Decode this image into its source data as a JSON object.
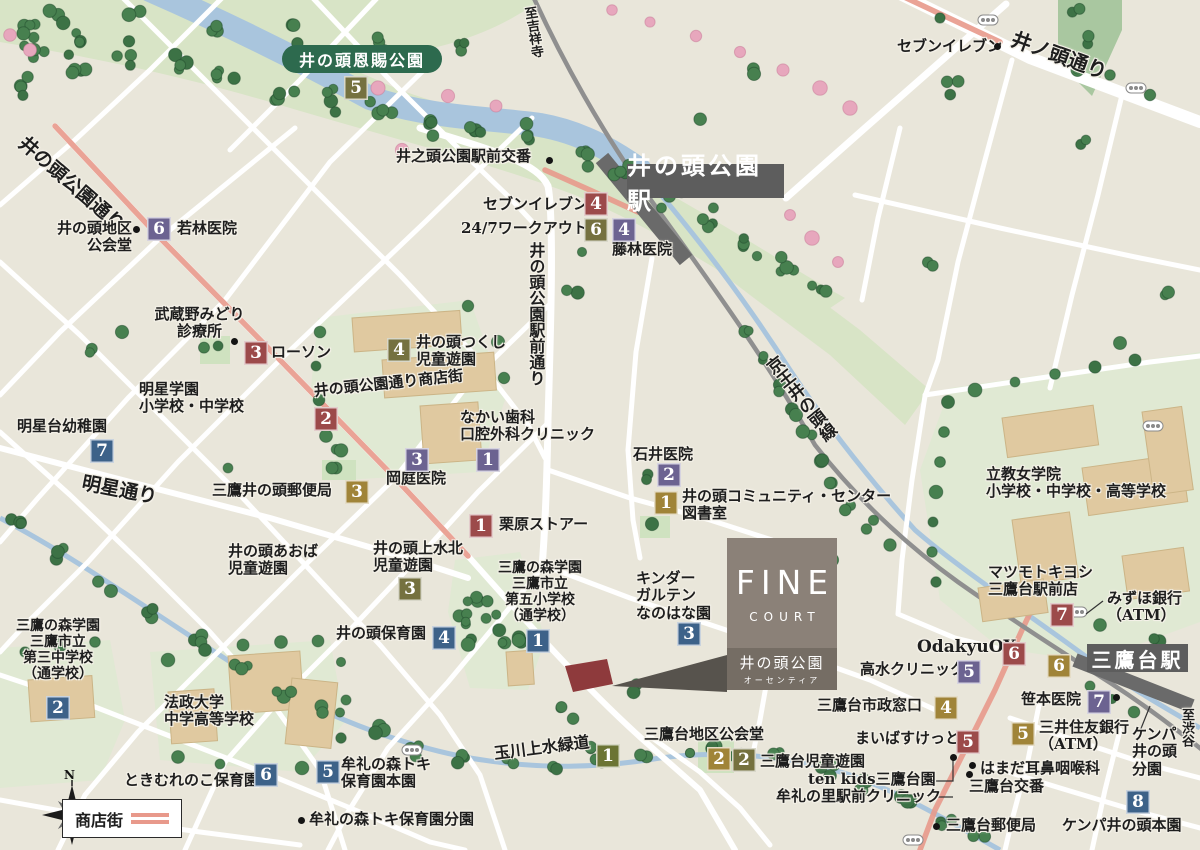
{
  "colors": {
    "land": "#e9e6da",
    "road": "#ffffff",
    "shopping": "#e8998b",
    "rail": "#8f8f8f",
    "station_band": "#6a6a6a",
    "station_bg": "#5d5d5d",
    "water": "#a9c5dd",
    "grass": "#d8e4c6",
    "campus": "#e0e9d3",
    "tree": "#47804f",
    "cherry": "#e7a7bd",
    "building": "#e0c9a0",
    "park_pill": "#2d6a4e",
    "fine_top": "#8b8178",
    "fine_bottom": "#756d64",
    "site": "#8e3a3c",
    "text": "#1e1e1e"
  },
  "badge_colors": {
    "red": "#9c4a4a",
    "purple": "#6c6391",
    "gold": "#a08438",
    "olive": "#75713f",
    "green": "#6b7434",
    "blue": "#3d6289"
  },
  "park_label": "井の頭恩賜公園",
  "stations": [
    {
      "name": "井の頭公園駅",
      "x": 627,
      "y": 164,
      "w": 157,
      "h": 34,
      "fs": 24
    },
    {
      "name": "三鷹台駅",
      "x": 1087,
      "y": 644,
      "w": 101,
      "h": 28,
      "fs": 20
    }
  ],
  "fine": {
    "top": "FINE",
    "sub": "COURT",
    "name": "井の頭公園",
    "kana": "オーセンティア"
  },
  "legend": {
    "label": "商店街"
  },
  "compass": {
    "n": "N"
  },
  "pois": [
    {
      "id": "poi-seven-eleven-north",
      "t": "セブンイレブン",
      "x": 897,
      "y": 38
    },
    {
      "id": "road-inokashira-dori",
      "t": "井ノ頭通り",
      "x": 1016,
      "y": 28,
      "r": 20,
      "s": 20
    },
    {
      "id": "poi-koban-north",
      "t": "井之頭公園駅前交番",
      "x": 396,
      "y": 148
    },
    {
      "id": "road-to-kichijoji",
      "t": "至吉祥寺",
      "x": 520,
      "y": 8,
      "v": 1,
      "s": 13,
      "r": -9
    },
    {
      "id": "poi-seven-eleven-station",
      "t": "セブンイレブン",
      "x": 483,
      "y": 196
    },
    {
      "id": "poi-247-workout",
      "t": "24/7ワークアウト",
      "x": 461,
      "y": 220
    },
    {
      "id": "poi-fujibayashi-clinic",
      "t": "藤林医院",
      "x": 612,
      "y": 241
    },
    {
      "id": "road-inokashira-koen-dori",
      "t": "井の頭公園通り",
      "x": 28,
      "y": 133,
      "r": 41,
      "s": 19
    },
    {
      "id": "poi-wakabayashi-clinic",
      "t": "若林医院",
      "x": 177,
      "y": 220
    },
    {
      "id": "poi-inokashira-chiku-kokaido",
      "t": "井の頭地区\n公会堂",
      "x": 48,
      "y": 220,
      "al": "right",
      "w": 84
    },
    {
      "id": "poi-musashino-midori-clinic",
      "t": "武蔵野みどり\n診療所",
      "x": 152,
      "y": 306,
      "al": "center",
      "w": 95
    },
    {
      "id": "poi-lawson",
      "t": "ローソン",
      "x": 271,
      "y": 344
    },
    {
      "id": "poi-meisei-gakuen",
      "t": "明星学園\n小学校・中学校",
      "x": 139,
      "y": 381
    },
    {
      "id": "poi-tsukushi-park",
      "t": "井の頭つくし\n児童遊園",
      "x": 416,
      "y": 334
    },
    {
      "id": "road-ekimae-dori",
      "t": "井の頭公園駅前通り",
      "x": 526,
      "y": 242,
      "v": 1,
      "s": 16
    },
    {
      "id": "poi-shotengai-label",
      "t": "井の頭公園通り商店街",
      "x": 313,
      "y": 383,
      "r": -6
    },
    {
      "id": "poi-nakai-dental",
      "t": "なかい歯科\n口腔外科クリニック",
      "x": 460,
      "y": 409
    },
    {
      "id": "poi-okaniwa-clinic",
      "t": "岡庭医院",
      "x": 386,
      "y": 470
    },
    {
      "id": "poi-myojodai-kindergarten",
      "t": "明星台幼稚園",
      "x": 17,
      "y": 418
    },
    {
      "id": "road-myojo-dori",
      "t": "明星通り",
      "x": 84,
      "y": 473,
      "r": 11,
      "s": 19
    },
    {
      "id": "poi-mitaka-inokashira-post",
      "t": "三鷹井の頭郵便局",
      "x": 212,
      "y": 482
    },
    {
      "id": "poi-ishii-clinic",
      "t": "石井医院",
      "x": 633,
      "y": 446
    },
    {
      "id": "poi-community-center",
      "t": "井の頭コミュニティ・センター\n図書室",
      "x": 682,
      "y": 488
    },
    {
      "id": "poi-kurihara-store",
      "t": "栗原ストアー",
      "x": 499,
      "y": 516
    },
    {
      "id": "poi-aoba-park",
      "t": "井の頭あおば\n児童遊園",
      "x": 228,
      "y": 543
    },
    {
      "id": "poi-josuikita-park",
      "t": "井の頭上水北\n児童遊園",
      "x": 373,
      "y": 540
    },
    {
      "id": "poi-daigo-elementary",
      "t": "三鷹の森学園\n三鷹市立\n第五小学校\n（通学校）",
      "x": 494,
      "y": 560,
      "al": "center",
      "w": 92,
      "s": 14
    },
    {
      "id": "poi-inokashira-hoikuen",
      "t": "井の頭保育園",
      "x": 336,
      "y": 625
    },
    {
      "id": "poi-kindergarten-nanohana",
      "t": "キンダー\nガルテン\nなのはな園",
      "x": 636,
      "y": 570
    },
    {
      "id": "rail-keio-inokashira-line",
      "t": "京王井の頭線",
      "x": 760,
      "y": 366,
      "v": 1,
      "s": 17,
      "r": -38
    },
    {
      "id": "poi-rikkyo-jogakuin",
      "t": "立教女学院\n小学校・中学校・高等学校",
      "x": 986,
      "y": 466
    },
    {
      "id": "poi-matsumotokiyoshi",
      "t": "マツモトキヨシ\n三鷹台駅前店",
      "x": 988,
      "y": 564
    },
    {
      "id": "poi-mizuho-bank",
      "t": "みずほ銀行\n（ATM）",
      "x": 1107,
      "y": 590
    },
    {
      "id": "poi-odakyu-ox",
      "t": "OdakyuOX",
      "x": 917,
      "y": 638,
      "s": 17
    },
    {
      "id": "poi-takamizu-clinic",
      "t": "高水クリニック",
      "x": 860,
      "y": 661
    },
    {
      "id": "poi-shisei-madoguchi",
      "t": "三鷹台市政窓口",
      "x": 817,
      "y": 697
    },
    {
      "id": "poi-sasamoto-clinic",
      "t": "笹本医院",
      "x": 1021,
      "y": 691
    },
    {
      "id": "poi-smbc-bank",
      "t": "三井住友銀行\n（ATM）",
      "x": 1039,
      "y": 719
    },
    {
      "id": "poi-maibasuketto",
      "t": "まいばすけっと",
      "x": 855,
      "y": 730
    },
    {
      "id": "poi-mitakadai-chiku-kokaido",
      "t": "三鷹台地区公会堂",
      "x": 644,
      "y": 726
    },
    {
      "id": "poi-mitakadai-jido-yuen",
      "t": "三鷹台児童遊園",
      "x": 760,
      "y": 753
    },
    {
      "id": "road-tamagawa-josui",
      "t": "玉川上水緑道",
      "x": 493,
      "y": 745,
      "r": -7,
      "s": 16
    },
    {
      "id": "poi-ten-kids",
      "t": "ten kids三鷹台園",
      "x": 808,
      "y": 771
    },
    {
      "id": "poi-murenosato-clinic",
      "t": "牟礼の里駅前クリニック",
      "x": 776,
      "y": 788
    },
    {
      "id": "poi-hamada-ent",
      "t": "はまだ耳鼻咽喉科",
      "x": 980,
      "y": 760
    },
    {
      "id": "poi-mitakadai-koban",
      "t": "三鷹台交番",
      "x": 969,
      "y": 778
    },
    {
      "id": "poi-kenpa-bunen",
      "t": "ケンパ\n井の頭\n分園",
      "x": 1132,
      "y": 726
    },
    {
      "id": "road-to-shibuya",
      "t": "至渋谷",
      "x": 1178,
      "y": 708,
      "v": 1,
      "s": 13
    },
    {
      "id": "poi-kenpa-honen",
      "t": "ケンパ井の頭本園",
      "x": 1062,
      "y": 817
    },
    {
      "id": "poi-mitakadai-post",
      "t": "三鷹台郵便局",
      "x": 946,
      "y": 817
    },
    {
      "id": "poi-daisan-junior-high",
      "t": "三鷹の森学園\n三鷹市立\n第三中学校\n（通学校）",
      "x": 8,
      "y": 618,
      "al": "center",
      "w": 100,
      "s": 14
    },
    {
      "id": "poi-hosei-univ-school",
      "t": "法政大学\n中学高等学校",
      "x": 164,
      "y": 694
    },
    {
      "id": "poi-tokimurenoko-hoikuen",
      "t": "ときむれのこ保育園",
      "x": 124,
      "y": 772
    },
    {
      "id": "poi-mure-toki-honen",
      "t": "牟礼の森トキ\n保育園本園",
      "x": 341,
      "y": 756
    },
    {
      "id": "poi-mure-toki-bunen",
      "t": "牟礼の森トキ保育園分園",
      "x": 309,
      "y": 811
    }
  ],
  "badges": [
    {
      "n": "5",
      "c": "olive",
      "x": 344,
      "y": 76
    },
    {
      "n": "4",
      "c": "red",
      "x": 584,
      "y": 192
    },
    {
      "n": "6",
      "c": "olive",
      "x": 584,
      "y": 218
    },
    {
      "n": "4",
      "c": "purple",
      "x": 612,
      "y": 218
    },
    {
      "n": "6",
      "c": "purple",
      "x": 147,
      "y": 217
    },
    {
      "n": "3",
      "c": "red",
      "x": 244,
      "y": 341
    },
    {
      "n": "2",
      "c": "red",
      "x": 314,
      "y": 407
    },
    {
      "n": "4",
      "c": "olive",
      "x": 387,
      "y": 338
    },
    {
      "n": "7",
      "c": "blue",
      "x": 90,
      "y": 439
    },
    {
      "n": "3",
      "c": "gold",
      "x": 345,
      "y": 480
    },
    {
      "n": "3",
      "c": "purple",
      "x": 405,
      "y": 448
    },
    {
      "n": "1",
      "c": "purple",
      "x": 476,
      "y": 448
    },
    {
      "n": "1",
      "c": "red",
      "x": 469,
      "y": 514
    },
    {
      "n": "2",
      "c": "purple",
      "x": 657,
      "y": 463
    },
    {
      "n": "1",
      "c": "gold",
      "x": 654,
      "y": 491
    },
    {
      "n": "3",
      "c": "olive",
      "x": 398,
      "y": 577
    },
    {
      "n": "1",
      "c": "blue",
      "x": 526,
      "y": 629
    },
    {
      "n": "4",
      "c": "blue",
      "x": 432,
      "y": 626
    },
    {
      "n": "3",
      "c": "blue",
      "x": 677,
      "y": 622
    },
    {
      "n": "5",
      "c": "purple",
      "x": 957,
      "y": 660
    },
    {
      "n": "6",
      "c": "red",
      "x": 1002,
      "y": 642
    },
    {
      "n": "6",
      "c": "gold",
      "x": 1047,
      "y": 654
    },
    {
      "n": "7",
      "c": "red",
      "x": 1050,
      "y": 603
    },
    {
      "n": "7",
      "c": "purple",
      "x": 1087,
      "y": 690
    },
    {
      "n": "5",
      "c": "gold",
      "x": 1011,
      "y": 722
    },
    {
      "n": "5",
      "c": "red",
      "x": 956,
      "y": 730
    },
    {
      "n": "4",
      "c": "gold",
      "x": 934,
      "y": 696
    },
    {
      "n": "2",
      "c": "gold",
      "x": 707,
      "y": 747
    },
    {
      "n": "2",
      "c": "olive",
      "x": 732,
      "y": 748
    },
    {
      "n": "1",
      "c": "green",
      "x": 596,
      "y": 744
    },
    {
      "n": "8",
      "c": "blue",
      "x": 1126,
      "y": 790
    },
    {
      "n": "2",
      "c": "blue",
      "x": 46,
      "y": 696
    },
    {
      "n": "6",
      "c": "blue",
      "x": 254,
      "y": 763
    },
    {
      "n": "5",
      "c": "blue",
      "x": 316,
      "y": 760
    }
  ],
  "dots": [
    {
      "x": 997,
      "y": 46
    },
    {
      "x": 549,
      "y": 160
    },
    {
      "x": 136,
      "y": 229
    },
    {
      "x": 234,
      "y": 341
    },
    {
      "x": 1116,
      "y": 697
    },
    {
      "x": 972,
      "y": 765
    },
    {
      "x": 969,
      "y": 774
    },
    {
      "x": 953,
      "y": 757
    },
    {
      "x": 936,
      "y": 826
    },
    {
      "x": 301,
      "y": 820
    }
  ]
}
